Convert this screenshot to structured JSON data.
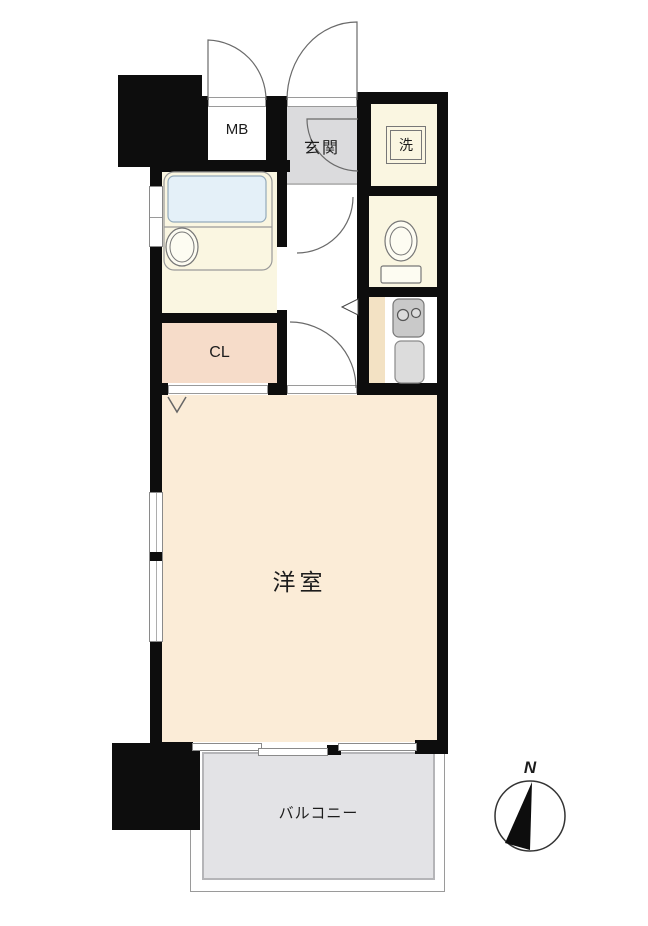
{
  "rooms": {
    "meter_box": {
      "label": "MB"
    },
    "entrance": {
      "label": "玄関"
    },
    "laundry": {
      "label": "洗"
    },
    "closet": {
      "label": "CL"
    },
    "western_room": {
      "label": "洋室"
    },
    "balcony": {
      "label": "バルコニー"
    }
  },
  "compass": {
    "north_label": "N"
  },
  "colors": {
    "wall": "#0d0d0d",
    "room_cream": "#FAF6E1",
    "room_peach": "#FBECD7",
    "closet_pink": "#F6DCC9",
    "entrance_gray": "#DBDBDD",
    "balcony_gray": "#E3E3E6",
    "bathtub_blue": "#E4F0F8",
    "kitchen_tan": "#F3E2C4"
  }
}
